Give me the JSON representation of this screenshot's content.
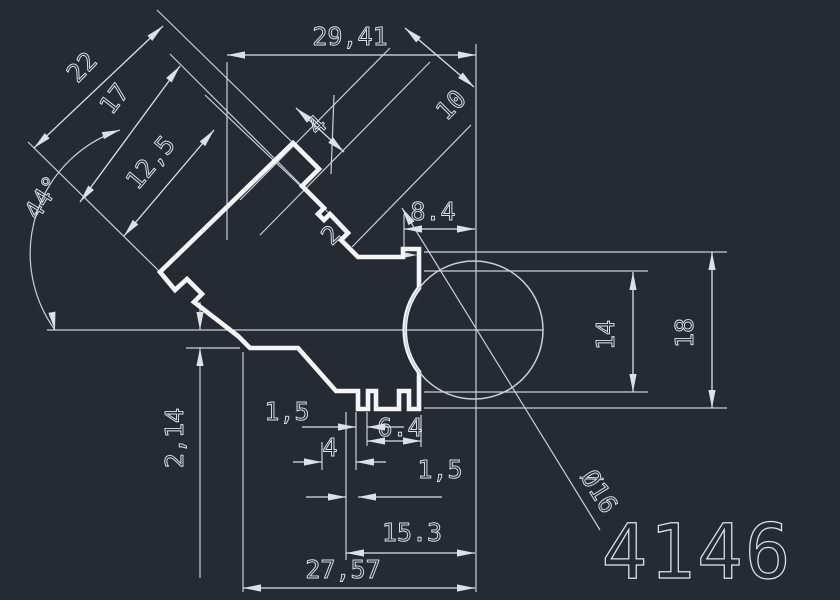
{
  "drawing": {
    "type": "cad-profile-cross-section",
    "part_number": "4146",
    "colors": {
      "background": "#262b33",
      "profile_line": "#f3f5f8",
      "dimension_line": "#dce1e8",
      "construction_line": "#c9cfd7",
      "text": "#dde2e9"
    },
    "dims": {
      "len_22": "22",
      "len_17": "17",
      "len_12_5": "12,5",
      "angle_44": "44°",
      "len_29_41": "29,41",
      "len_4_top": "4",
      "len_10": "10",
      "len_8_4": "8.4",
      "len_2": "2",
      "len_14": "14",
      "len_18": "18",
      "len_2_14": "2,14",
      "len_1_5_left": "1,5",
      "len_6_4": "6.4",
      "len_4_bottom": "4",
      "len_1_5_right": "1,5",
      "len_15_3": "15.3",
      "len_27_57": "27,57",
      "dia_16": "Ø16"
    }
  }
}
